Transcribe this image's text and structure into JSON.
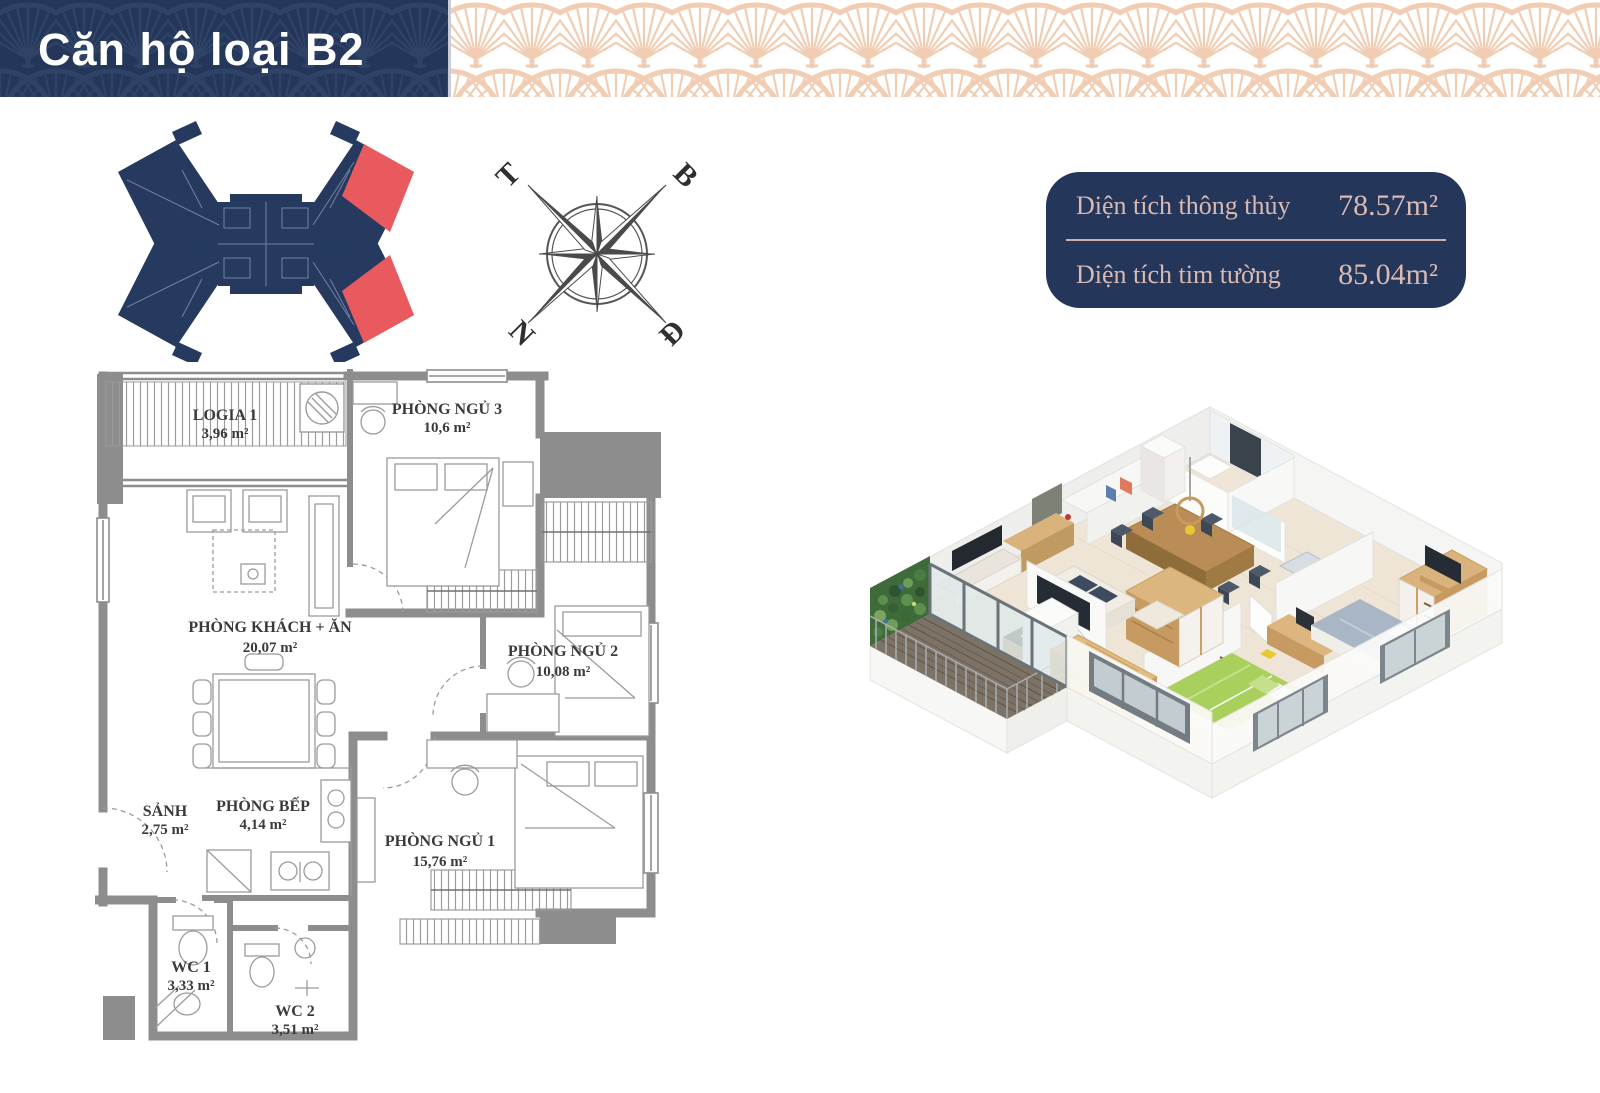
{
  "header": {
    "title": "Căn hộ loại B2"
  },
  "area_summary": {
    "rows": [
      {
        "label": "Diện tích thông thủy",
        "value": "78.57m²"
      },
      {
        "label": "Diện tích tim tường",
        "value": "85.04m²"
      }
    ]
  },
  "compass": {
    "top_left": "T",
    "top_right": "B",
    "bottom_left": "N",
    "bottom_right": "Đ"
  },
  "site_plan": {
    "building_color": "#253a5e",
    "highlight_color": "#e85a5e",
    "highlighted_units_count": 2
  },
  "floor_plan": {
    "rooms": [
      {
        "name": "LOGIA 1",
        "area": "3,96 m²"
      },
      {
        "name": "PHÒNG NGỦ 3",
        "area": "10,6 m²"
      },
      {
        "name": "PHÒNG KHÁCH + ĂN",
        "area": "20,07 m²"
      },
      {
        "name": "PHÒNG NGỦ 2",
        "area": "10,08 m²"
      },
      {
        "name": "SẢNH",
        "area": "2,75 m²"
      },
      {
        "name": "PHÒNG BẾP",
        "area": "4,14 m²"
      },
      {
        "name": "PHÒNG NGỦ 1",
        "area": "15,76 m²"
      },
      {
        "name": "WC 1",
        "area": "3,33 m²"
      },
      {
        "name": "WC 2",
        "area": "3,51 m²"
      }
    ]
  },
  "colors": {
    "navy": "#24375b",
    "pattern_peach": "#f1cdb3",
    "text_pink": "#d9b9b1",
    "wall_gray": "#8d8d8d"
  }
}
